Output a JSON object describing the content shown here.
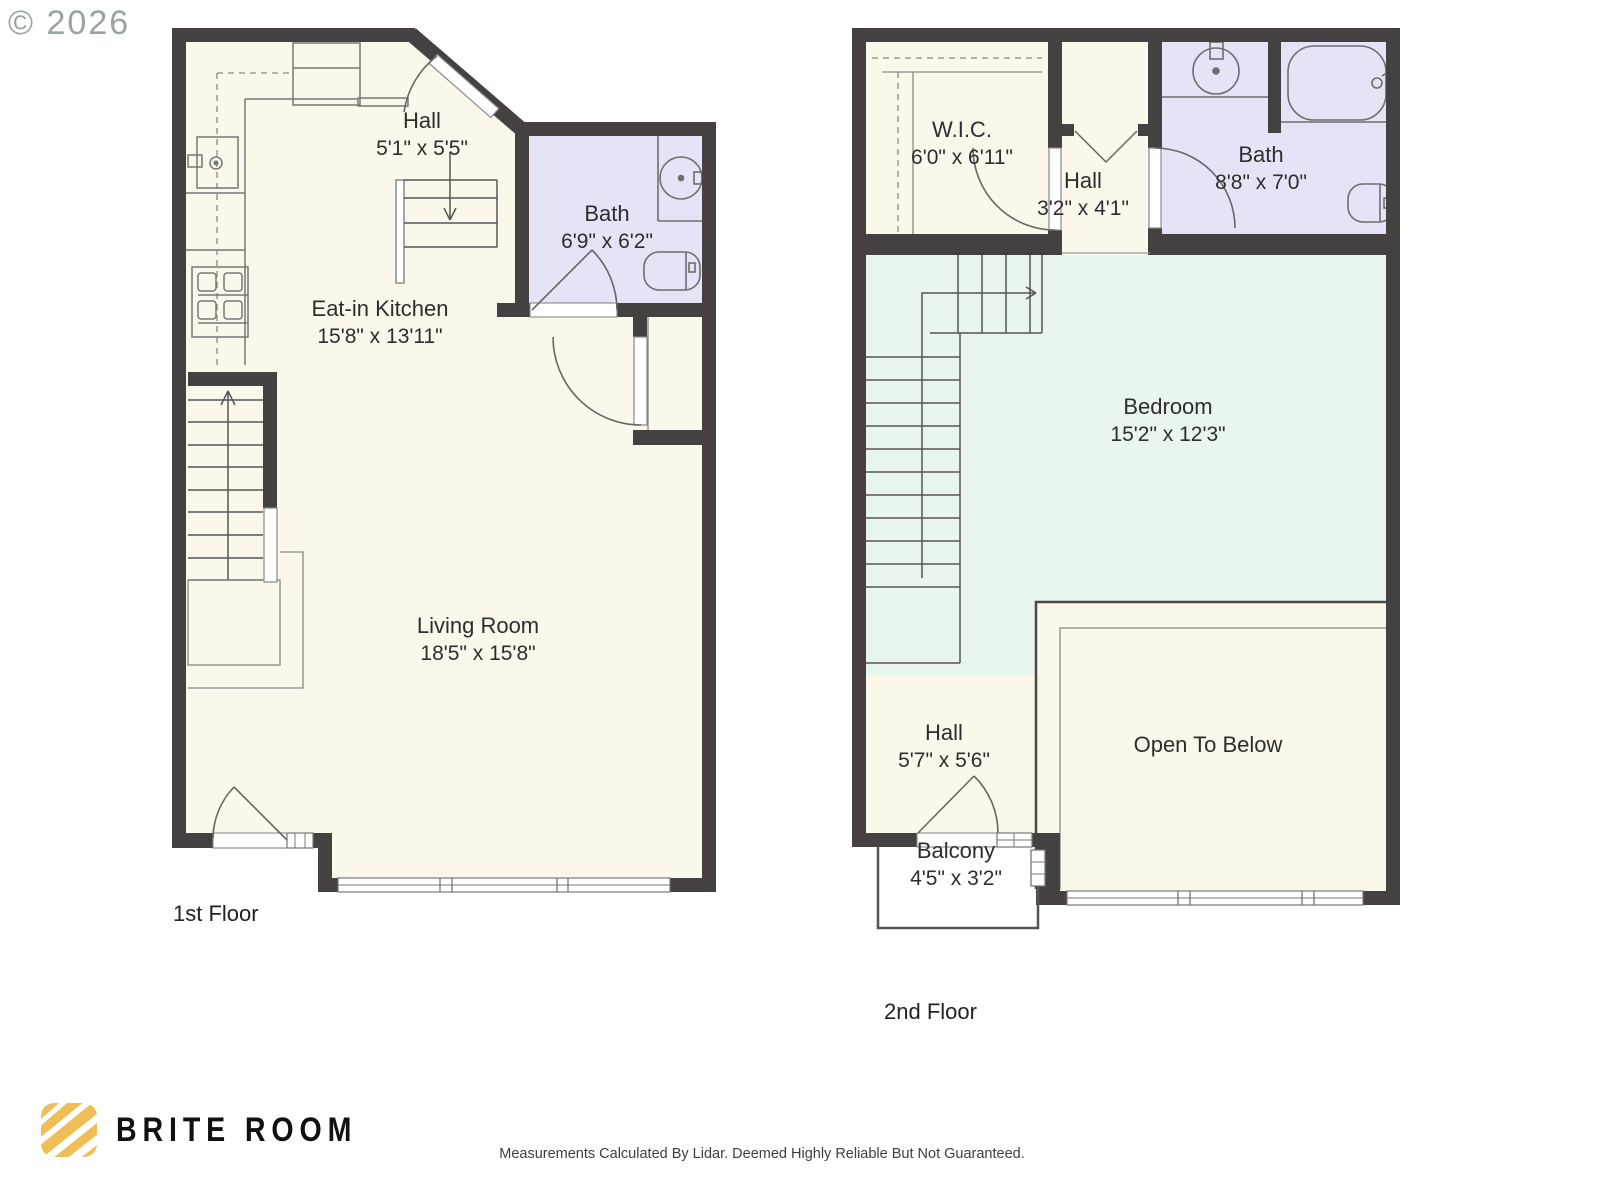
{
  "watermark": "© 2026",
  "floors": [
    {
      "label": "1st Floor",
      "rooms": [
        {
          "name": "Hall",
          "dims": "5'1\" x 5'5\""
        },
        {
          "name": "Bath",
          "dims": "6'9\" x 6'2\""
        },
        {
          "name": "Eat-in Kitchen",
          "dims": "15'8\" x 13'11\""
        },
        {
          "name": "Living Room",
          "dims": "18'5\" x 15'8\""
        }
      ]
    },
    {
      "label": "2nd Floor",
      "rooms": [
        {
          "name": "W.I.C.",
          "dims": "6'0\" x 6'11\""
        },
        {
          "name": "Hall",
          "dims": "3'2\" x 4'1\""
        },
        {
          "name": "Bath",
          "dims": "8'8\" x 7'0\""
        },
        {
          "name": "Bedroom",
          "dims": "15'2\" x 12'3\""
        },
        {
          "name": "Hall",
          "dims": "5'7\" x 5'6\""
        },
        {
          "name": "Open To Below",
          "dims": ""
        },
        {
          "name": "Balcony",
          "dims": "4'5\" x 3'2\""
        }
      ]
    }
  ],
  "branding": {
    "logo_text": "BRITE ROOM",
    "logo_color": "#EFBE57"
  },
  "disclaimer": "Measurements Calculated By Lidar. Deemed Highly Reliable But Not Guaranteed.",
  "colors": {
    "wall": "#454140",
    "floor": "#FBF8EB",
    "bath_floor": "#E4E4F6",
    "bedroom_floor": "#E9F6EE",
    "line": "#777777"
  }
}
